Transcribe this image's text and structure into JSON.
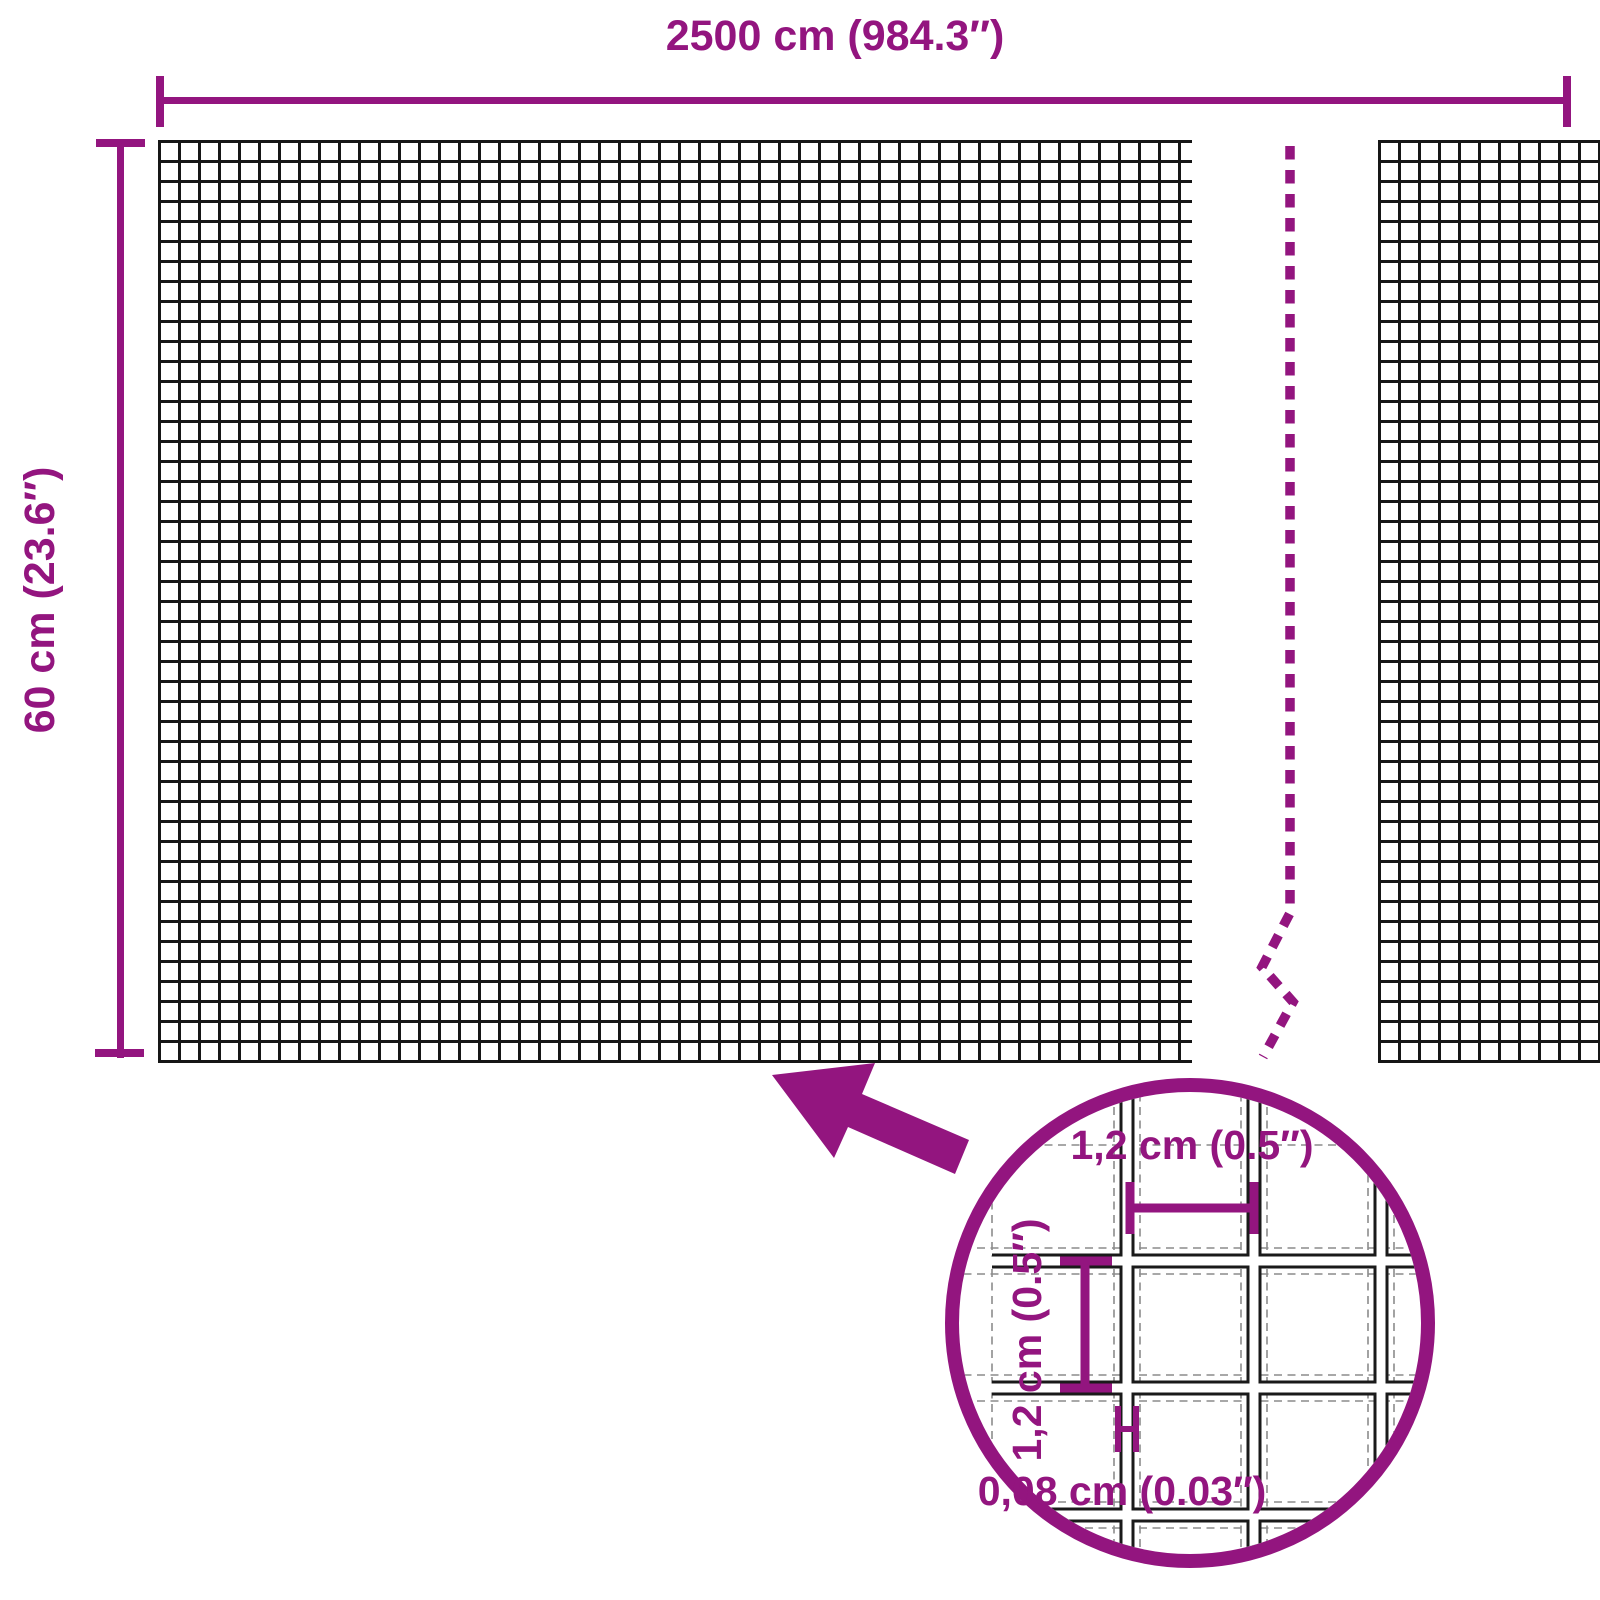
{
  "title": "Wire mesh product dimension diagram",
  "colors": {
    "accent": "#93157F",
    "mesh_line": "#161616",
    "construction_line": "#8c8c8c"
  },
  "dimensions": {
    "width": {
      "label": "2500 cm (984.3″)"
    },
    "height": {
      "label": "60 cm (23.6″)"
    }
  },
  "detail": {
    "mesh_cell_width": {
      "label": "1,2 cm (0.5″)"
    },
    "mesh_cell_height": {
      "label": "1,2 cm (0.5″)"
    },
    "wire_thickness": {
      "label": "0,08 cm (0.03″)"
    }
  }
}
